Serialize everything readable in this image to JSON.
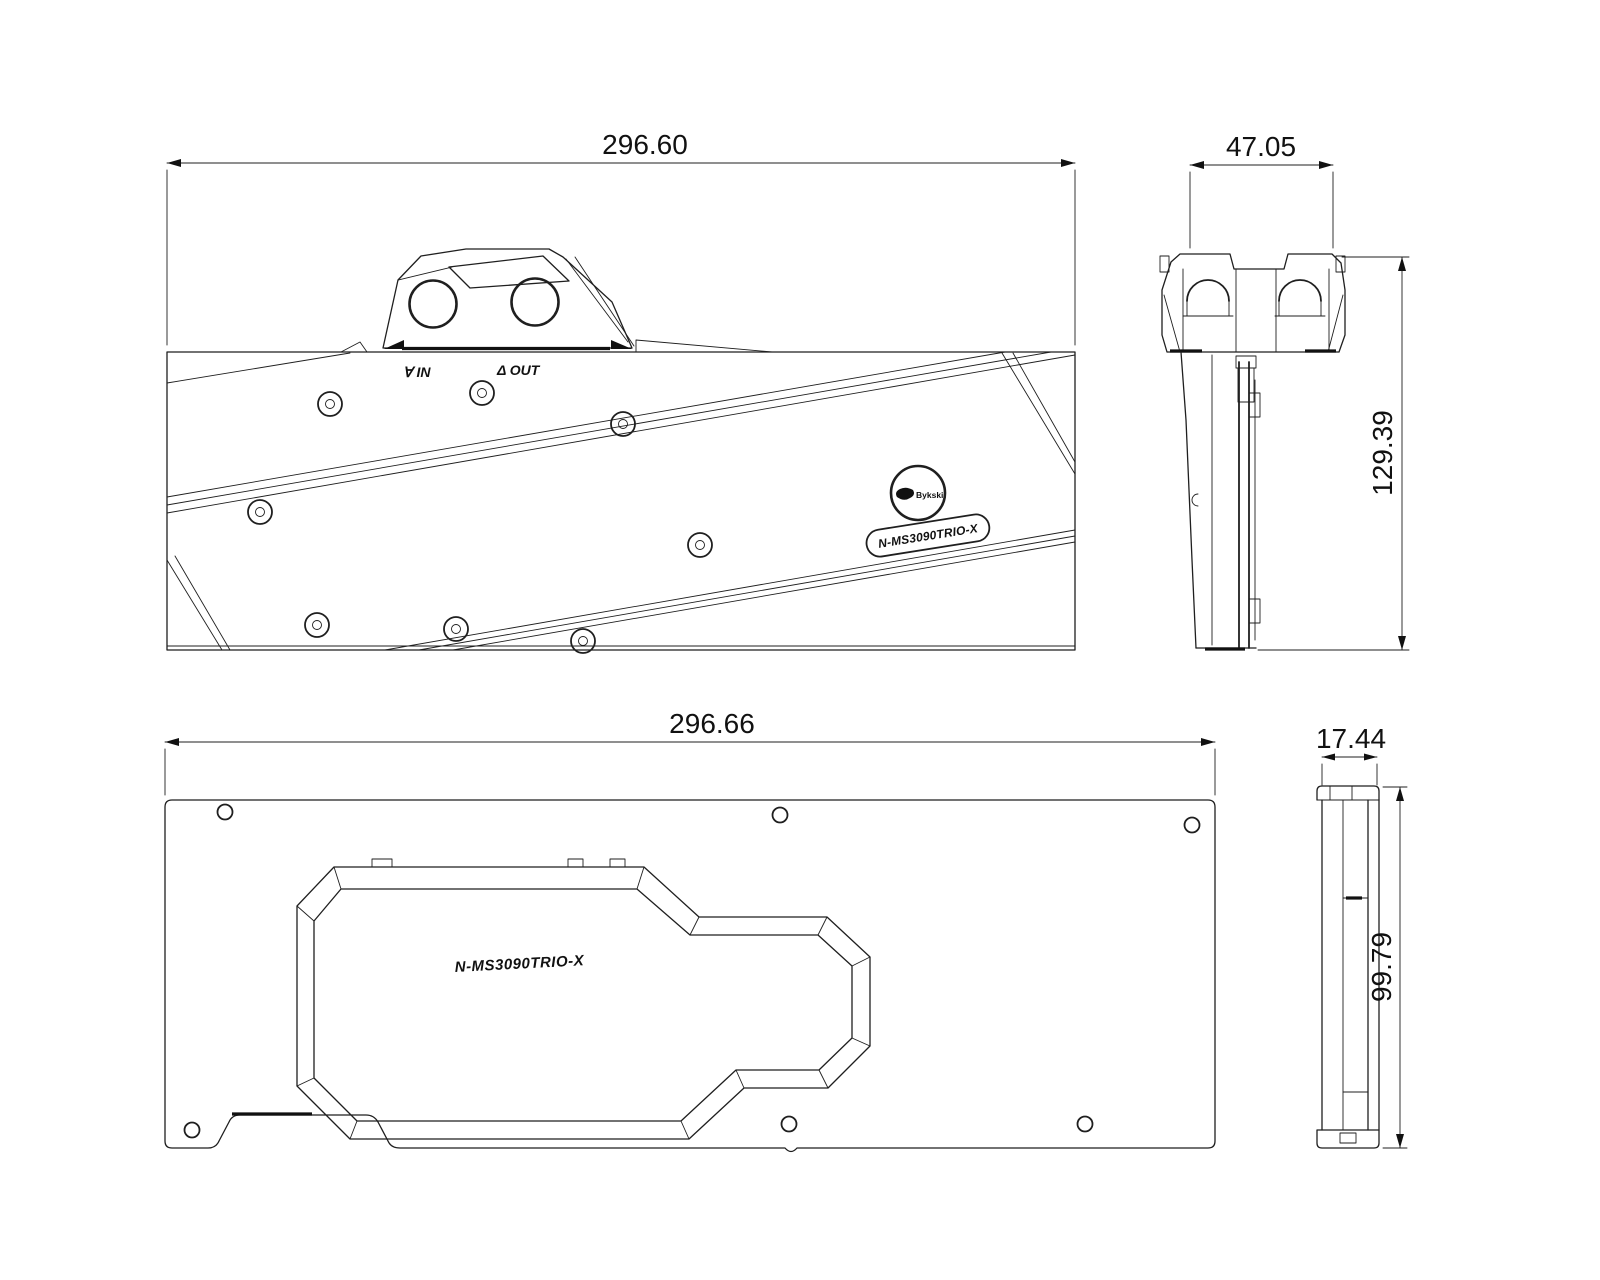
{
  "drawing": {
    "front": {
      "width_dim": "296.60",
      "port_in": "∀ IN",
      "port_out": "Δ OUT",
      "brand": "Bykski",
      "model": "N-MS3090TRIO-X"
    },
    "side": {
      "width_dim": "47.05",
      "height_dim": "129.39"
    },
    "backplate": {
      "width_dim": "296.66",
      "model": "N-MS3090TRIO-X"
    },
    "backplate_side": {
      "width_dim": "17.44",
      "height_dim": "99.79"
    },
    "colors": {
      "line": "#1f1f1f",
      "background": "#ffffff"
    }
  }
}
